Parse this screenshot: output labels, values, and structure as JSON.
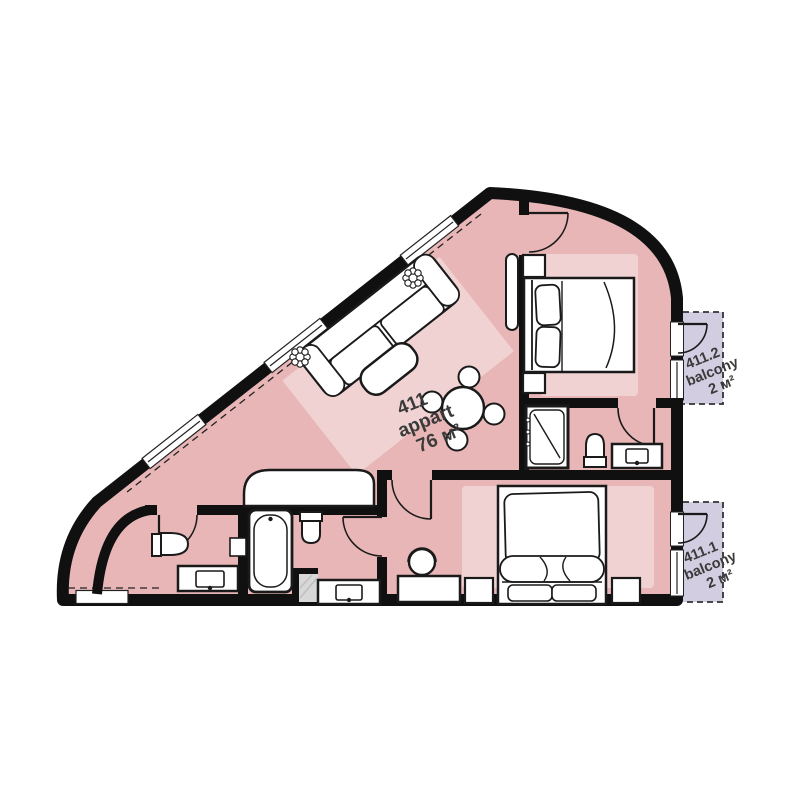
{
  "apartment": {
    "number": "411",
    "type_label": "appart",
    "area": "76 м²"
  },
  "balconies": [
    {
      "number": "411.2",
      "label": "balcony",
      "area": "2 м²"
    },
    {
      "number": "411.1",
      "label": "balcony",
      "area": "2 м²"
    }
  ],
  "colors": {
    "floor": "#e8b6b6",
    "rug": "#f1d2d2",
    "balcony_floor": "#d2cde0",
    "wall": "#101010",
    "label_text": "#3a3a3a",
    "outside": "#ffffff"
  }
}
